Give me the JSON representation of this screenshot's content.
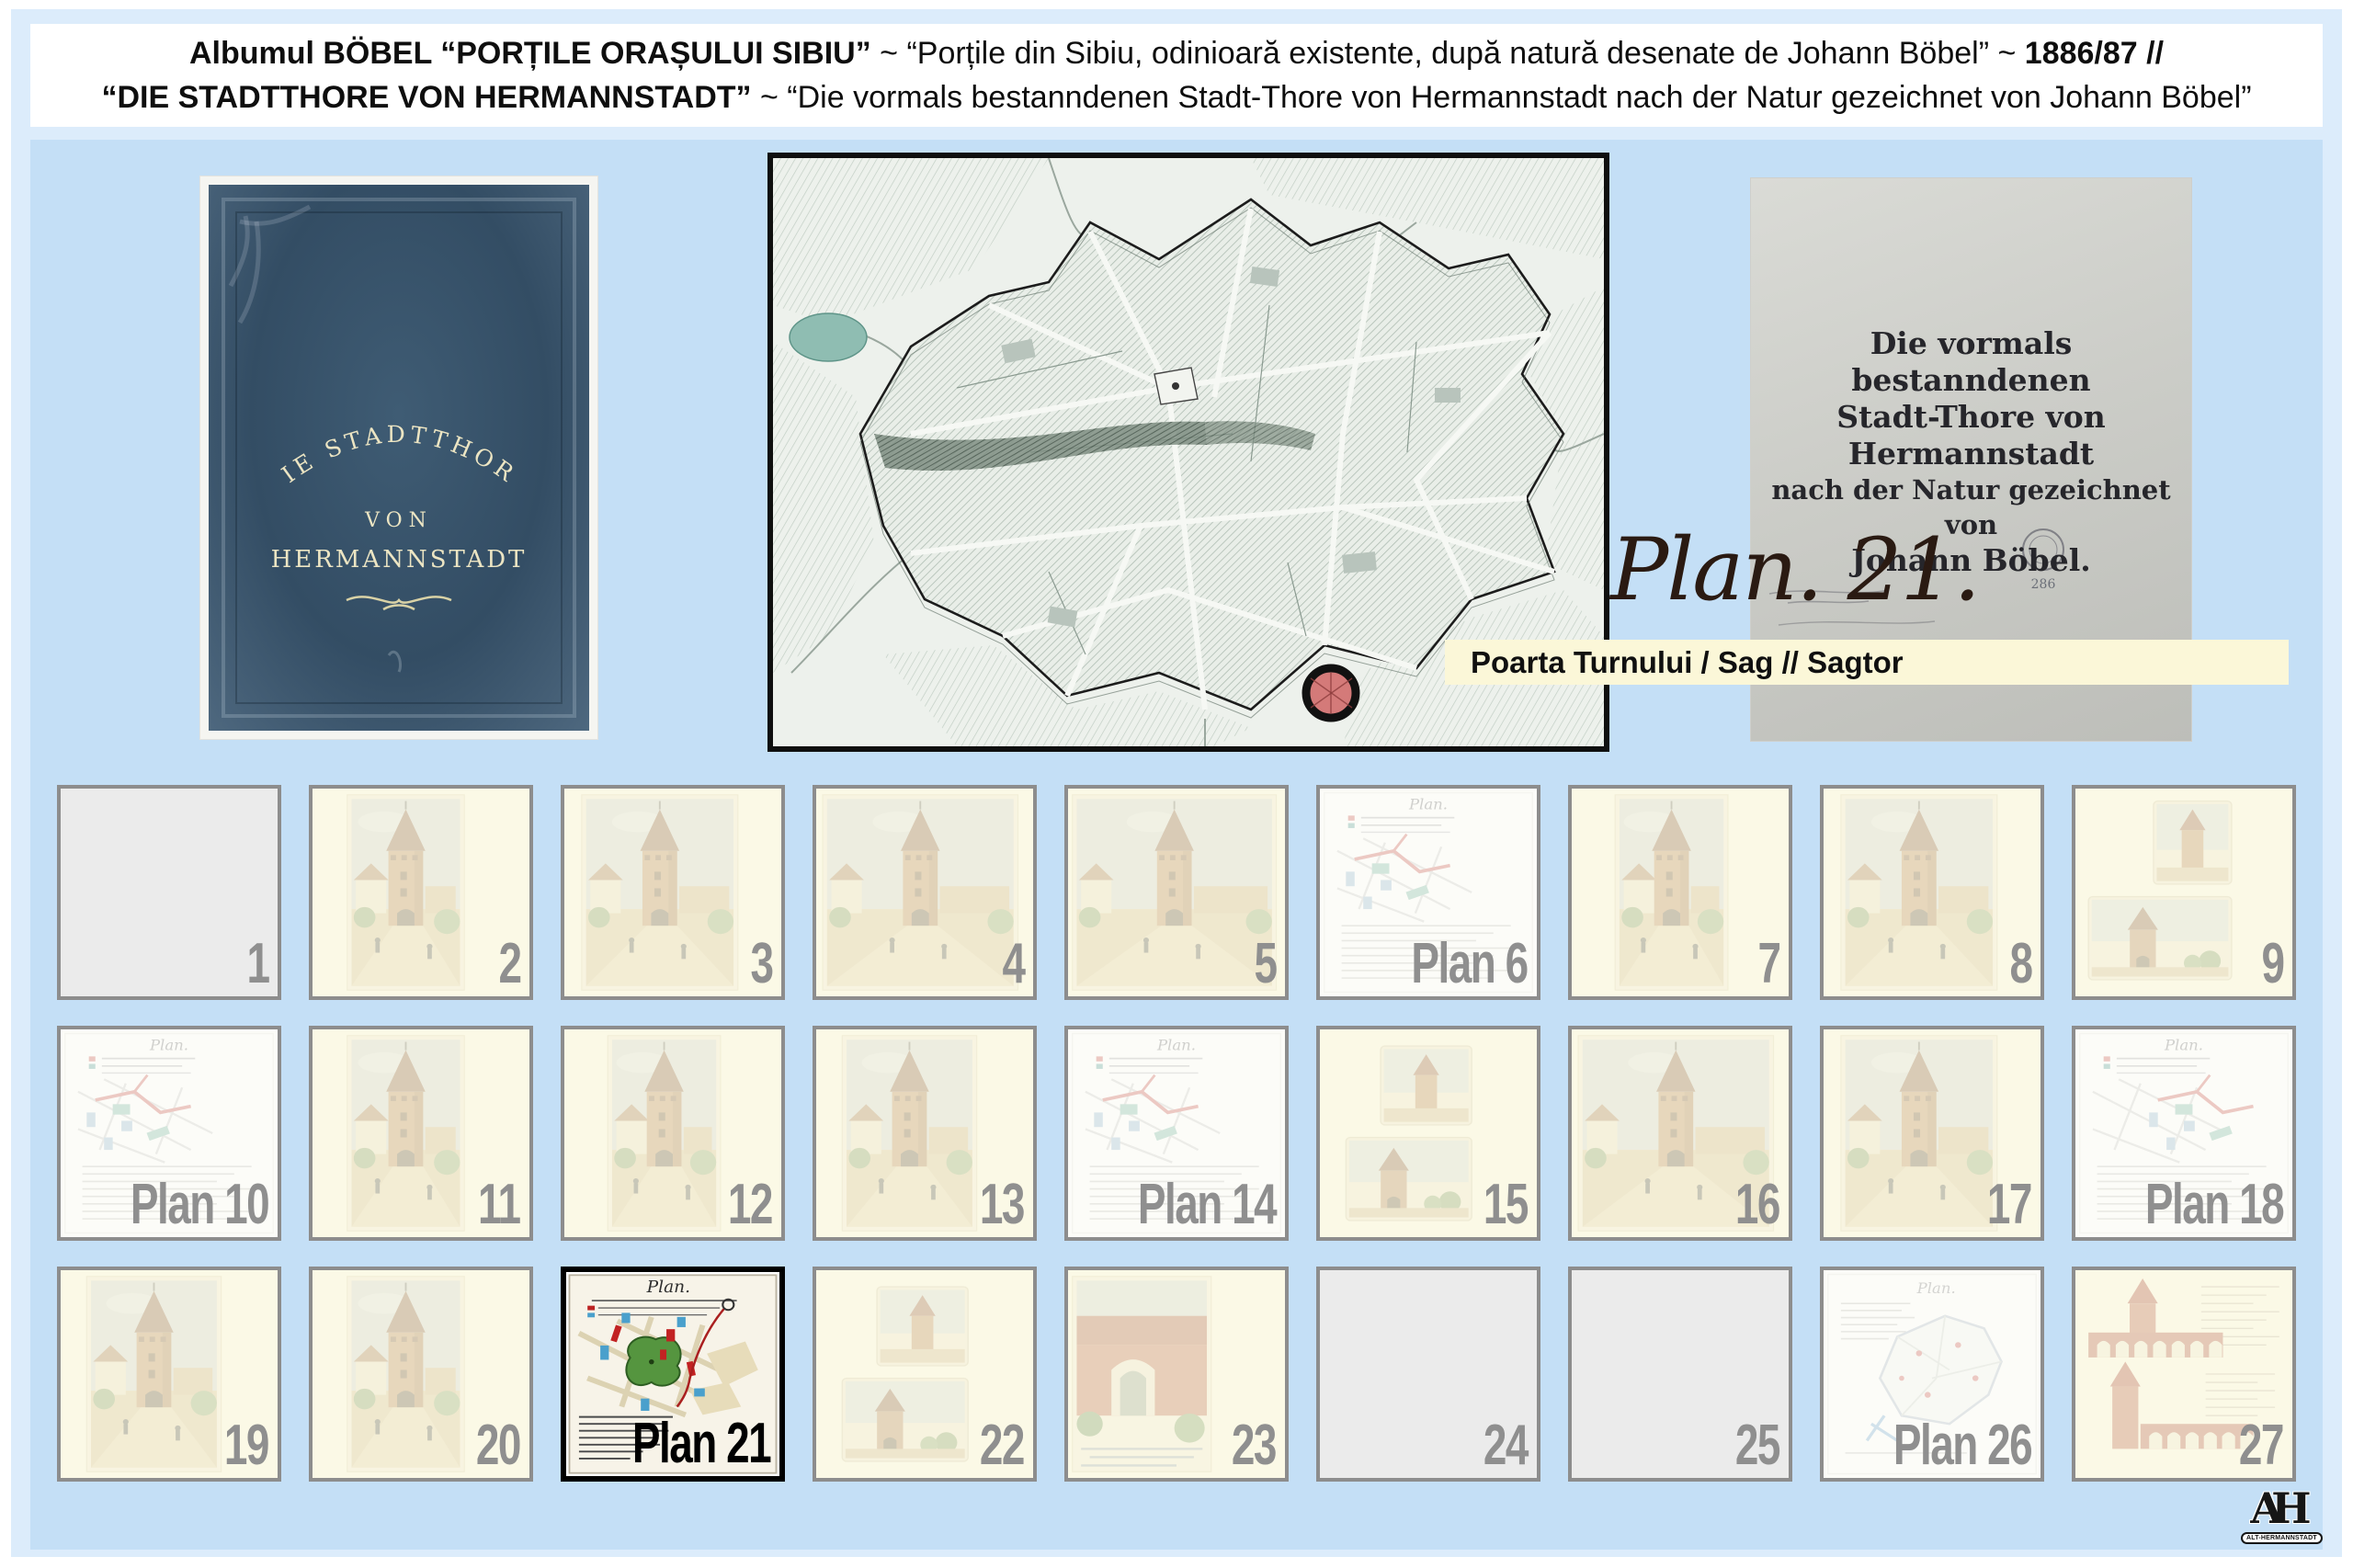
{
  "header": {
    "line1": [
      {
        "text": "Albumul BÖBEL",
        "bold": true
      },
      {
        "text": " “PORȚILE ORAȘULUI SIBIU”",
        "bold": true
      },
      {
        "text": " ~ “Porțile din Sibiu, odinioară existente, după natură desenate de Johann Böbel” ~ ",
        "bold": false
      },
      {
        "text": "1886/87 //",
        "bold": true
      }
    ],
    "line2": [
      {
        "text": "“DIE STADTTHORE VON HERMANNSTADT”",
        "bold": true
      },
      {
        "text": " ~ “Die vormals bestanndenen Stadt-Thore von Hermannstadt nach der Natur gezeichnet von Johann Böbel”",
        "bold": false
      }
    ]
  },
  "book_cover": {
    "arc_text": "DIE STADTTHORE",
    "line_von": "VON",
    "line_city": "HERMANNSTADT"
  },
  "title_page": {
    "lines": [
      "Die vormals bestanndenen",
      "Stadt-Thore von Hermannstadt",
      "nach der Natur gezeichnet von",
      "Johann Böbel."
    ],
    "stamp_number": "286"
  },
  "plan_label": {
    "script": "Plan. 21.",
    "bar_text": "Poarta Turnului / Sag // Sagtor"
  },
  "plan_sheet_title": "Plan.",
  "logo": {
    "monogram": "AH",
    "badge": "ALT-HERMANNSTADT"
  },
  "colors": {
    "outer_panel": "#dcecfb",
    "inner_panel": "#c4dff6",
    "label_bar": "#fbf7d8",
    "thumb_border": "#8d8d8d",
    "thumb_number": "#8f8f8f",
    "selected_border": "#000000",
    "marker_fill": "#d05a5a",
    "cover_blue": "#33umber4d64"
  },
  "thumbnails": [
    {
      "label": "1",
      "prefix": "",
      "type": "empty",
      "variant": 0,
      "selected": false
    },
    {
      "label": "2",
      "prefix": "",
      "type": "tower",
      "variant": 0,
      "selected": false
    },
    {
      "label": "3",
      "prefix": "",
      "type": "tower",
      "variant": 1,
      "selected": false
    },
    {
      "label": "4",
      "prefix": "",
      "type": "tower",
      "variant": 2,
      "selected": false
    },
    {
      "label": "5",
      "prefix": "",
      "type": "tower",
      "variant": 5,
      "selected": false
    },
    {
      "label": "6",
      "prefix": "Plan",
      "type": "plan",
      "variant": 0,
      "selected": false
    },
    {
      "label": "7",
      "prefix": "",
      "type": "tower",
      "variant": 3,
      "selected": false
    },
    {
      "label": "8",
      "prefix": "",
      "type": "tower",
      "variant": 1,
      "selected": false
    },
    {
      "label": "9",
      "prefix": "",
      "type": "twosmall",
      "variant": 1,
      "selected": false
    },
    {
      "label": "10",
      "prefix": "Plan",
      "type": "plan",
      "variant": 0,
      "selected": false
    },
    {
      "label": "11",
      "prefix": "",
      "type": "tower",
      "variant": 0,
      "selected": false
    },
    {
      "label": "12",
      "prefix": "",
      "type": "tower",
      "variant": 3,
      "selected": false
    },
    {
      "label": "13",
      "prefix": "",
      "type": "tower",
      "variant": 4,
      "selected": false
    },
    {
      "label": "14",
      "prefix": "Plan",
      "type": "plan",
      "variant": 1,
      "selected": false
    },
    {
      "label": "15",
      "prefix": "",
      "type": "twosmall",
      "variant": 0,
      "selected": false
    },
    {
      "label": "16",
      "prefix": "",
      "type": "tower",
      "variant": 2,
      "selected": false
    },
    {
      "label": "17",
      "prefix": "",
      "type": "tower",
      "variant": 1,
      "selected": false
    },
    {
      "label": "18",
      "prefix": "Plan",
      "type": "plan",
      "variant": 2,
      "selected": false
    },
    {
      "label": "19",
      "prefix": "",
      "type": "tower",
      "variant": 4,
      "selected": false
    },
    {
      "label": "20",
      "prefix": "",
      "type": "tower",
      "variant": 0,
      "selected": false
    },
    {
      "label": "21",
      "prefix": "Plan",
      "type": "plan21",
      "variant": 0,
      "selected": true
    },
    {
      "label": "22",
      "prefix": "",
      "type": "twosmall",
      "variant": 0,
      "selected": false
    },
    {
      "label": "23",
      "prefix": "",
      "type": "redwall",
      "variant": 0,
      "selected": false
    },
    {
      "label": "24",
      "prefix": "",
      "type": "empty",
      "variant": 0,
      "selected": false
    },
    {
      "label": "25",
      "prefix": "",
      "type": "empty",
      "variant": 0,
      "selected": false
    },
    {
      "label": "26",
      "prefix": "Plan",
      "type": "plan26",
      "variant": 0,
      "selected": false
    },
    {
      "label": "27",
      "prefix": "",
      "type": "viaduct",
      "variant": 0,
      "selected": false
    }
  ]
}
